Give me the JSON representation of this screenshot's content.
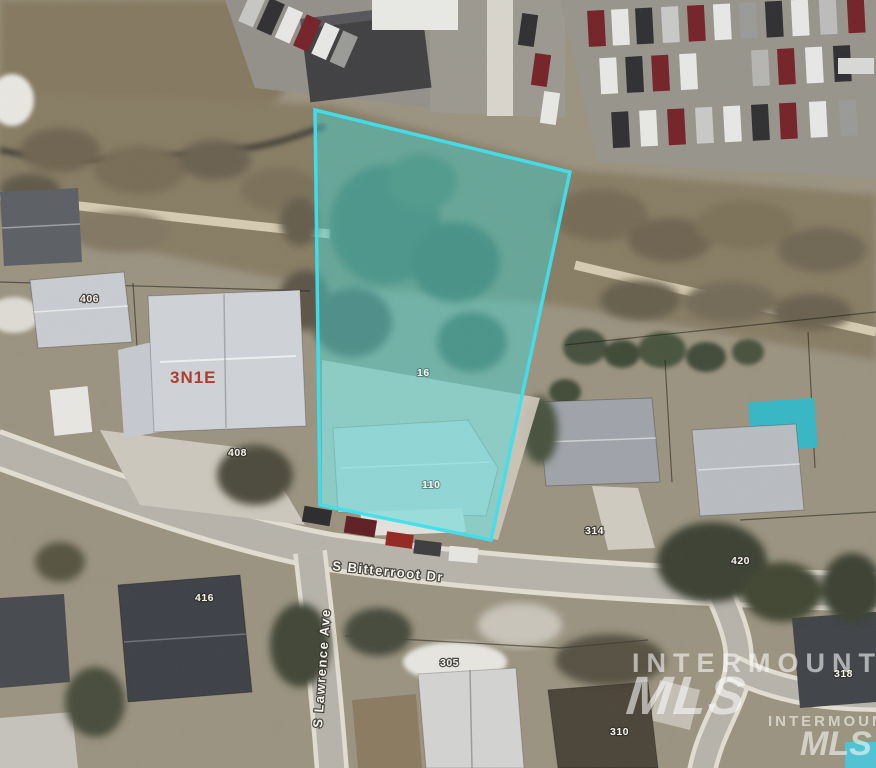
{
  "map": {
    "kind": "aerial-parcel-view",
    "parcel": {
      "lot_label": "16",
      "address_label": "110",
      "highlight_fill": "#3FD9D9",
      "highlight_outline": "#3CE1EF"
    },
    "township_label": "3N1E",
    "streets": {
      "bitterroot": "S Bitterroot Dr",
      "lawrence": "S Lawrence Ave"
    },
    "house_numbers": {
      "h406": "406",
      "h408": "408",
      "h314": "314",
      "h420": "420",
      "h416": "416",
      "h305": "305",
      "h310": "310",
      "h318": "318"
    },
    "watermark": {
      "name": "INTERMOUNTAIN",
      "mls": "MLS",
      "name_small": "INTERMOUNTAIN",
      "mls_small": "MLS"
    }
  }
}
